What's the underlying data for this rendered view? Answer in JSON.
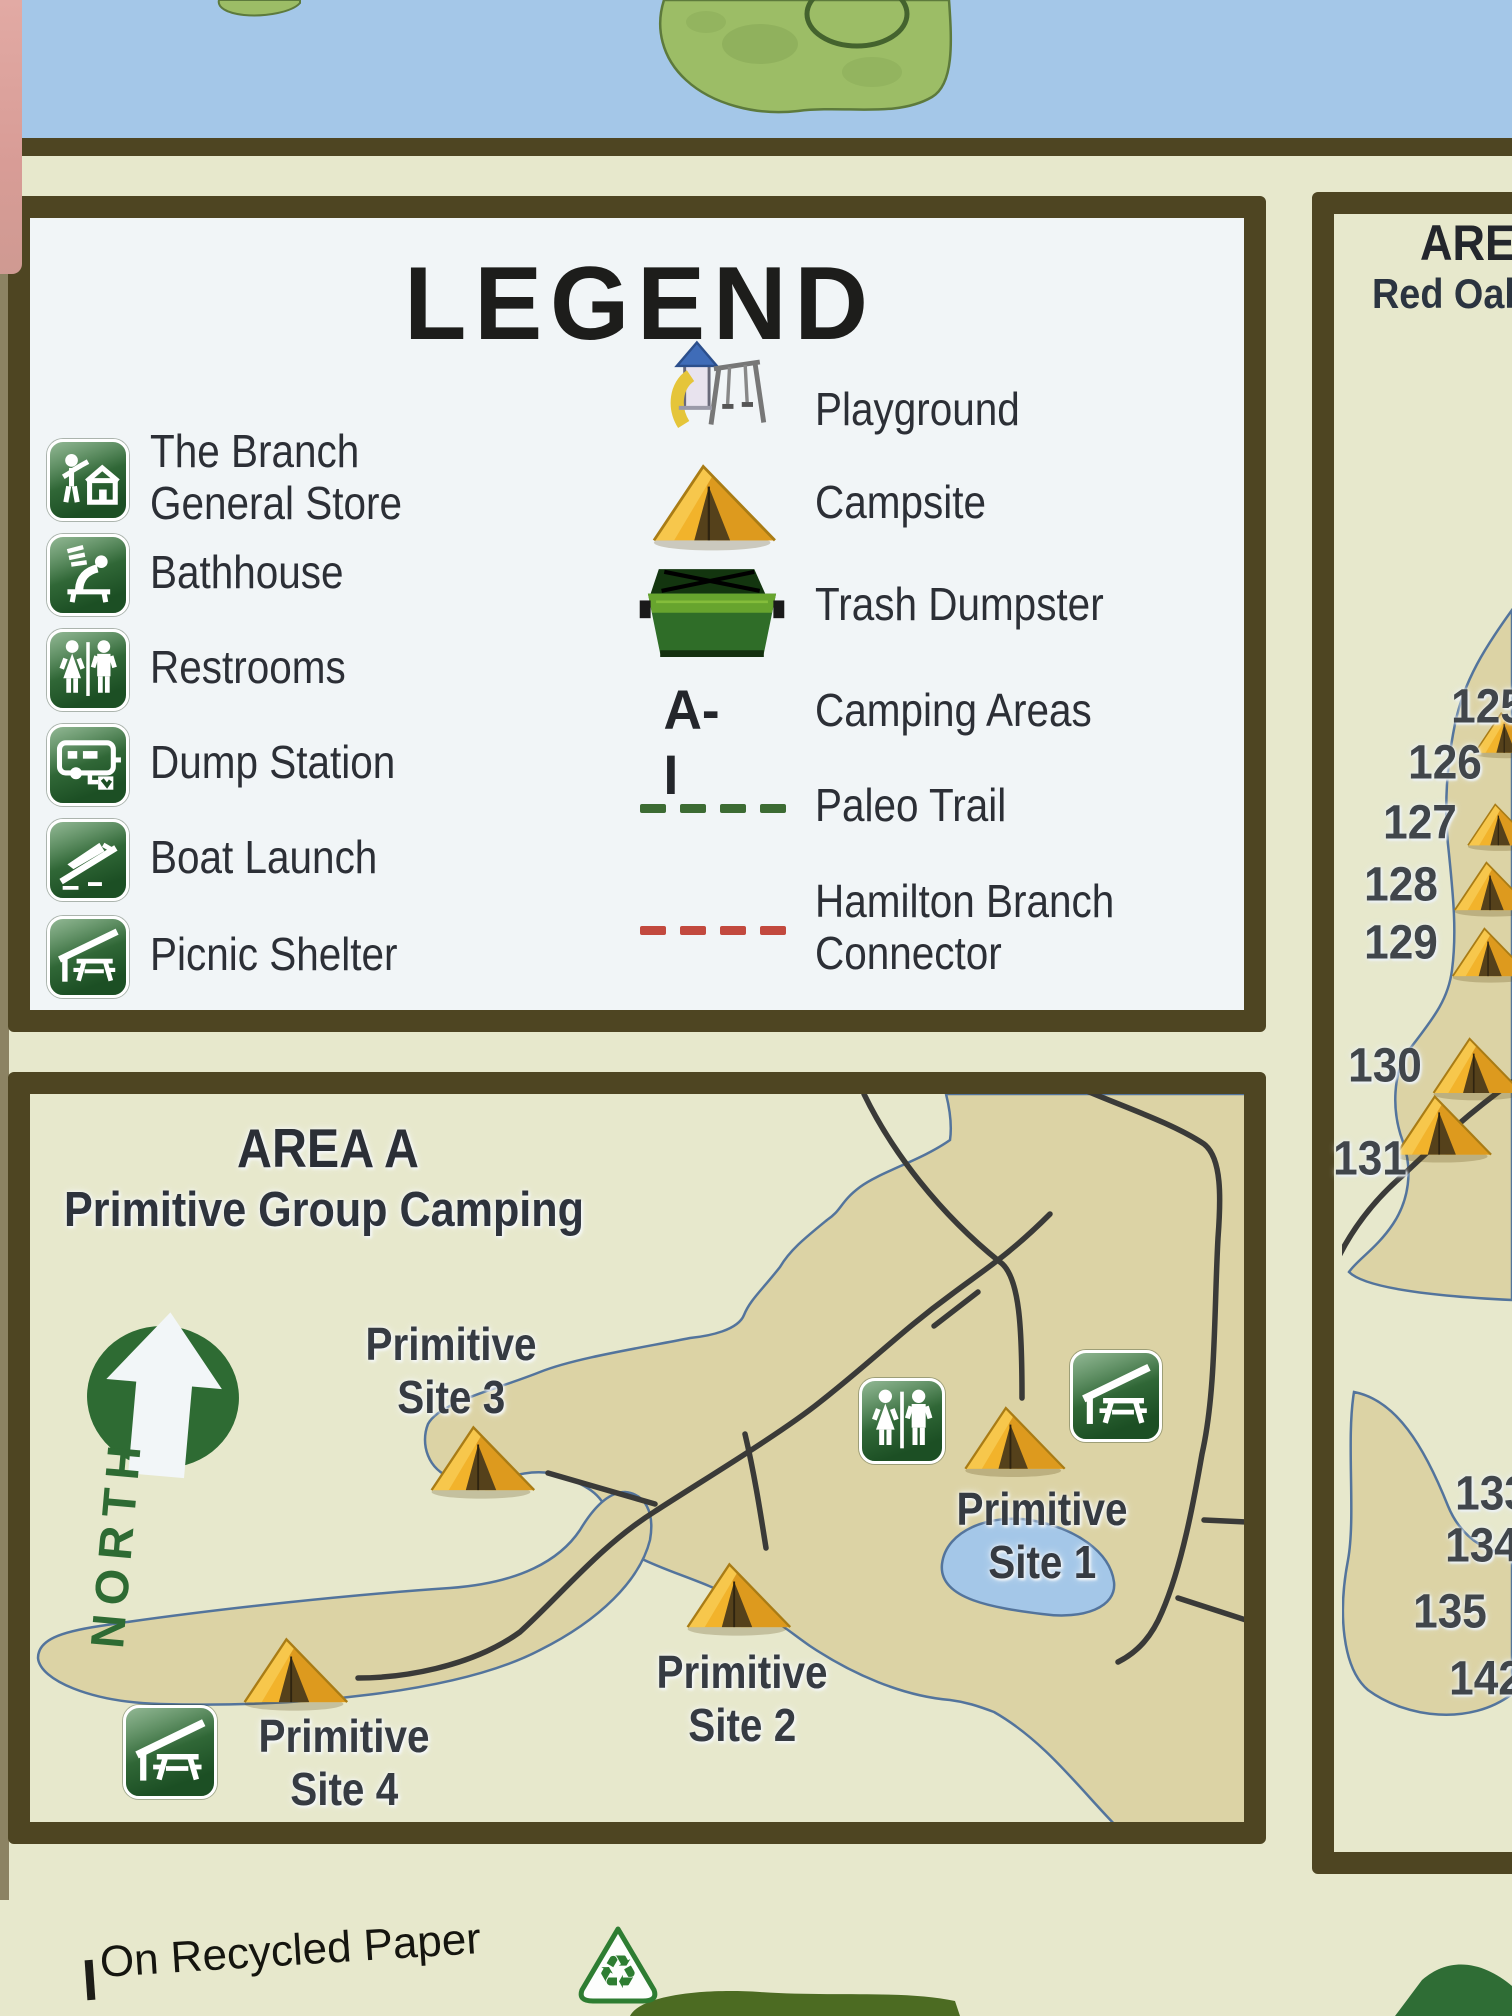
{
  "colors": {
    "water": "#a4c7e8",
    "land": "#dcd3a5",
    "shore": "#53749c",
    "road": "#3a3a38",
    "panel_border": "#4e4522",
    "cream": "#e7e8cc",
    "legend_bg": "#f1f5f7",
    "icon_green_dark": "#1c4f24",
    "icon_green_light": "#4e8b52",
    "tent_gold": "#f2b32b",
    "paleo_dash": "#3c6b33",
    "hamilton_dash": "#c2493e",
    "north_green": "#2e6b33",
    "island_green": "#9cbd66"
  },
  "legend": {
    "title": "LEGEND",
    "items_left": [
      {
        "icon": "general-store-icon",
        "label_lines": [
          "The Branch",
          "General Store"
        ]
      },
      {
        "icon": "bathhouse-icon",
        "label_lines": [
          "Bathhouse"
        ]
      },
      {
        "icon": "restrooms-icon",
        "label_lines": [
          "Restrooms"
        ]
      },
      {
        "icon": "dump-station-icon",
        "label_lines": [
          "Dump Station"
        ]
      },
      {
        "icon": "boat-launch-icon",
        "label_lines": [
          "Boat Launch"
        ]
      },
      {
        "icon": "picnic-shelter-icon",
        "label_lines": [
          "Picnic Shelter"
        ]
      }
    ],
    "items_right": [
      {
        "icon": "playground-icon",
        "label_lines": [
          "Playground"
        ]
      },
      {
        "icon": "campsite-icon",
        "label_lines": [
          "Campsite"
        ]
      },
      {
        "icon": "trash-dumpster-icon",
        "label_lines": [
          "Trash Dumpster"
        ]
      },
      {
        "icon": "camping-areas-range",
        "symbol": "A-I",
        "label_lines": [
          "Camping Areas"
        ]
      },
      {
        "icon": "paleo-trail-dash",
        "label_lines": [
          "Paleo Trail"
        ]
      },
      {
        "icon": "hamilton-branch-dash",
        "label_lines": [
          "Hamilton Branch",
          "Connector"
        ]
      }
    ]
  },
  "area_a": {
    "title": "AREA A",
    "subtitle": "Primitive Group Camping",
    "north_label": "NORTH",
    "site_labels": [
      {
        "lines": [
          "Primitive",
          "Site 3"
        ],
        "x": 451,
        "y": 1318
      },
      {
        "lines": [
          "Primitive",
          "Site 1"
        ],
        "x": 1042,
        "y": 1483
      },
      {
        "lines": [
          "Primitive",
          "Site 2"
        ],
        "x": 742,
        "y": 1646
      },
      {
        "lines": [
          "Primitive",
          "Site 4"
        ],
        "x": 344,
        "y": 1710
      }
    ],
    "tents": [
      {
        "x": 481,
        "y": 1459,
        "s": 0.95
      },
      {
        "x": 1013,
        "y": 1438,
        "s": 0.92
      },
      {
        "x": 737,
        "y": 1596,
        "s": 0.95
      },
      {
        "x": 294,
        "y": 1671,
        "s": 0.95
      }
    ],
    "icons": [
      {
        "type": "restrooms-icon",
        "x": 902,
        "y": 1421,
        "s": 86
      },
      {
        "type": "picnic-shelter-icon",
        "x": 1116,
        "y": 1396,
        "s": 92
      },
      {
        "type": "picnic-shelter-icon",
        "x": 170,
        "y": 1752,
        "s": 94
      }
    ]
  },
  "right_panel": {
    "title": "AREA",
    "subtitle": "Red Oak",
    "numbers": [
      {
        "n": "125",
        "x": 1488,
        "y": 707
      },
      {
        "n": "126",
        "x": 1445,
        "y": 763
      },
      {
        "n": "127",
        "x": 1420,
        "y": 823
      },
      {
        "n": "128",
        "x": 1401,
        "y": 885
      },
      {
        "n": "129",
        "x": 1401,
        "y": 943
      },
      {
        "n": "130",
        "x": 1385,
        "y": 1066
      },
      {
        "n": "131",
        "x": 1370,
        "y": 1159
      },
      {
        "n": "133",
        "x": 1492,
        "y": 1494
      },
      {
        "n": "134",
        "x": 1482,
        "y": 1546
      },
      {
        "n": "135",
        "x": 1450,
        "y": 1612
      },
      {
        "n": "142",
        "x": 1486,
        "y": 1679
      }
    ],
    "tents": [
      {
        "x": 1506,
        "y": 733,
        "s": 0.6
      },
      {
        "x": 1500,
        "y": 825,
        "s": 0.62
      },
      {
        "x": 1492,
        "y": 886,
        "s": 0.72
      },
      {
        "x": 1490,
        "y": 952,
        "s": 0.72
      },
      {
        "x": 1476,
        "y": 1066,
        "s": 0.82
      },
      {
        "x": 1442,
        "y": 1126,
        "s": 0.88
      }
    ]
  },
  "footer": {
    "recycled_text": "On Recycled Paper"
  }
}
